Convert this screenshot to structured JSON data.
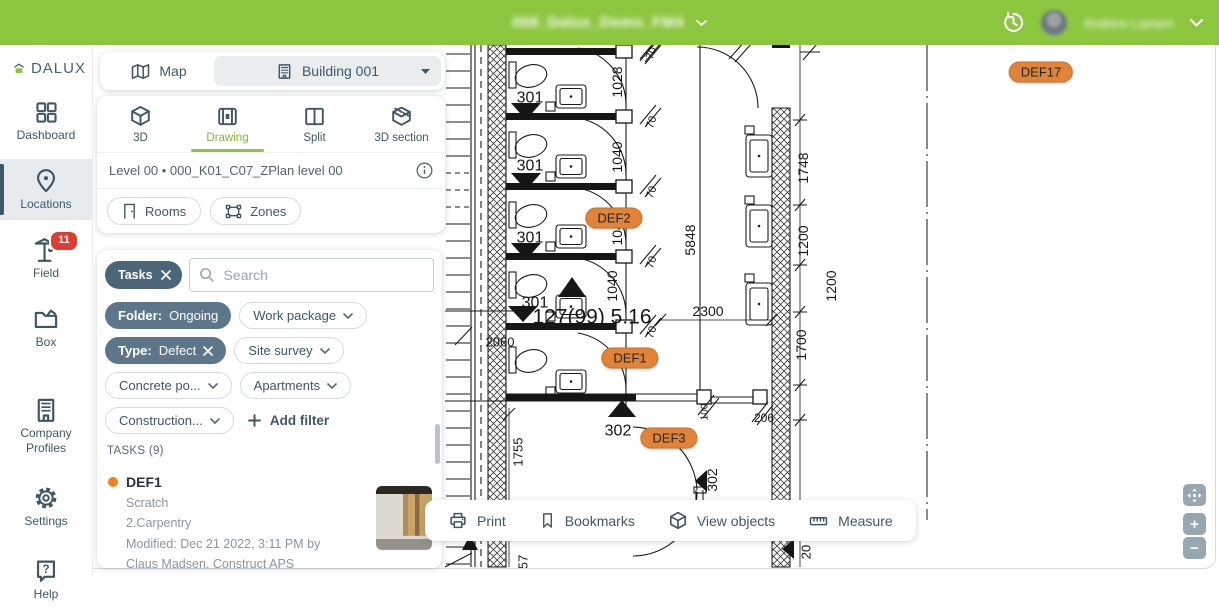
{
  "header": {
    "title": "008_Dalux_Demo_FM4",
    "user_name": "Anders Larsen"
  },
  "sidebar": {
    "logo_text": "DALUX",
    "items": [
      {
        "label": "Dashboard",
        "icon": "dashboard-icon"
      },
      {
        "label": "Locations",
        "icon": "locations-icon",
        "active": true
      },
      {
        "label": "Field",
        "icon": "field-crane-icon",
        "badge": "11"
      },
      {
        "label": "Box",
        "icon": "box-folder-icon"
      },
      {
        "label": "Company Profiles",
        "icon": "company-profiles-icon"
      },
      {
        "label": "Settings",
        "icon": "settings-gear-icon"
      },
      {
        "label": "Help",
        "icon": "help-icon"
      }
    ]
  },
  "map_toggle": {
    "map_label": "Map",
    "building_label": "Building 001"
  },
  "view_card": {
    "tabs": [
      {
        "label": "3D",
        "icon": "cube-3d-icon"
      },
      {
        "label": "Drawing",
        "icon": "drawing-icon",
        "active": true
      },
      {
        "label": "Split",
        "icon": "split-icon"
      },
      {
        "label": "3D section",
        "icon": "cube-section-icon"
      }
    ],
    "level_label": "Level 00 • 000_K01_C07_ZPlan level 00",
    "rooms_label": "Rooms",
    "zones_label": "Zones"
  },
  "filter_panel": {
    "tasks_chip": "Tasks",
    "search_placeholder": "Search",
    "chips": [
      {
        "text": "Folder:",
        "value": "Ongoing"
      },
      {
        "text": "Work package"
      },
      {
        "text": "Type:",
        "value": "Defect"
      },
      {
        "text": "Site survey"
      },
      {
        "text": "Concrete po..."
      },
      {
        "text": "Apartments"
      },
      {
        "text": "Construction..."
      },
      {
        "text": "Add filter"
      }
    ],
    "tasks_count_label": "TASKS (9)",
    "task": {
      "id": "DEF1",
      "status_color": "#F5821F",
      "title": "Scratch",
      "discipline": "2.Carpentry",
      "modified_line1": "Modified: Dec 21 2022, 3:11 PM by",
      "modified_line2": "Claus Madsen, Construct APS"
    }
  },
  "toolbar": {
    "items": [
      {
        "label": "Print",
        "icon": "print-icon"
      },
      {
        "label": "Bookmarks",
        "icon": "bookmark-icon"
      },
      {
        "label": "View objects",
        "icon": "cube-3d-icon"
      },
      {
        "label": "Measure",
        "icon": "ruler-icon"
      }
    ]
  },
  "zoom_controls": {
    "zoom_in_label": "+",
    "zoom_out_label": "−"
  },
  "drawing": {
    "colors": {
      "marker_bg": "#E28438",
      "marker_border": "#C4732C",
      "accent_green": "#8CC63F"
    },
    "markers": [
      {
        "label": "DEF17",
        "x": 1041,
        "y": 72
      },
      {
        "label": "DEF2",
        "x": 614,
        "y": 218
      },
      {
        "label": "DEF1",
        "x": 630,
        "y": 358
      },
      {
        "label": "DEF3",
        "x": 669,
        "y": 438
      }
    ],
    "labels": [
      {
        "t": "1028",
        "x": 617,
        "y": 82,
        "r": -90,
        "s": 14
      },
      {
        "t": "1040",
        "x": 617,
        "y": 157,
        "r": -90,
        "s": 14
      },
      {
        "t": "1040",
        "x": 617,
        "y": 230,
        "r": -90,
        "s": 14
      },
      {
        "t": "1040",
        "x": 612,
        "y": 286,
        "r": -90,
        "s": 14
      },
      {
        "t": "301",
        "x": 530,
        "y": 97,
        "r": 0,
        "s": 16
      },
      {
        "t": "301",
        "x": 530,
        "y": 165,
        "r": 0,
        "s": 16
      },
      {
        "t": "301",
        "x": 530,
        "y": 237,
        "r": 0,
        "s": 16
      },
      {
        "t": "301",
        "x": 535,
        "y": 302,
        "r": 0,
        "s": 16
      },
      {
        "t": "70",
        "x": 651,
        "y": 53,
        "r": -70,
        "s": 11
      },
      {
        "t": "70",
        "x": 651,
        "y": 122,
        "r": -70,
        "s": 11
      },
      {
        "t": "70",
        "x": 651,
        "y": 192,
        "r": -70,
        "s": 11
      },
      {
        "t": "70",
        "x": 651,
        "y": 262,
        "r": -70,
        "s": 11
      },
      {
        "t": "70",
        "x": 651,
        "y": 332,
        "r": -70,
        "s": 11
      },
      {
        "t": "5848",
        "x": 690,
        "y": 240,
        "r": -90,
        "s": 14
      },
      {
        "t": "1748",
        "x": 803,
        "y": 168,
        "r": -90,
        "s": 14
      },
      {
        "t": "1200",
        "x": 803,
        "y": 241,
        "r": -90,
        "s": 14
      },
      {
        "t": "1200",
        "x": 831,
        "y": 286,
        "r": -90,
        "s": 14
      },
      {
        "t": "1700",
        "x": 801,
        "y": 345,
        "r": -90,
        "s": 14
      },
      {
        "t": "2300",
        "x": 708,
        "y": 311,
        "r": 0,
        "s": 14
      },
      {
        "t": "127(99) 5.16",
        "x": 592,
        "y": 316,
        "r": 0,
        "s": 21
      },
      {
        "t": "2060",
        "x": 500,
        "y": 342,
        "r": 0,
        "s": 13
      },
      {
        "t": "302",
        "x": 618,
        "y": 430,
        "r": 0,
        "s": 16
      },
      {
        "t": "302",
        "x": 712,
        "y": 480,
        "r": -90,
        "s": 14
      },
      {
        "t": "100",
        "x": 704,
        "y": 412,
        "r": -90,
        "s": 10
      },
      {
        "t": "206",
        "x": 764,
        "y": 418,
        "r": 0,
        "s": 12
      },
      {
        "t": "1755",
        "x": 518,
        "y": 452,
        "r": -90,
        "s": 13
      },
      {
        "t": "57",
        "x": 523,
        "y": 562,
        "r": -90,
        "s": 13
      },
      {
        "t": "20",
        "x": 806,
        "y": 552,
        "r": -90,
        "s": 13
      }
    ]
  }
}
